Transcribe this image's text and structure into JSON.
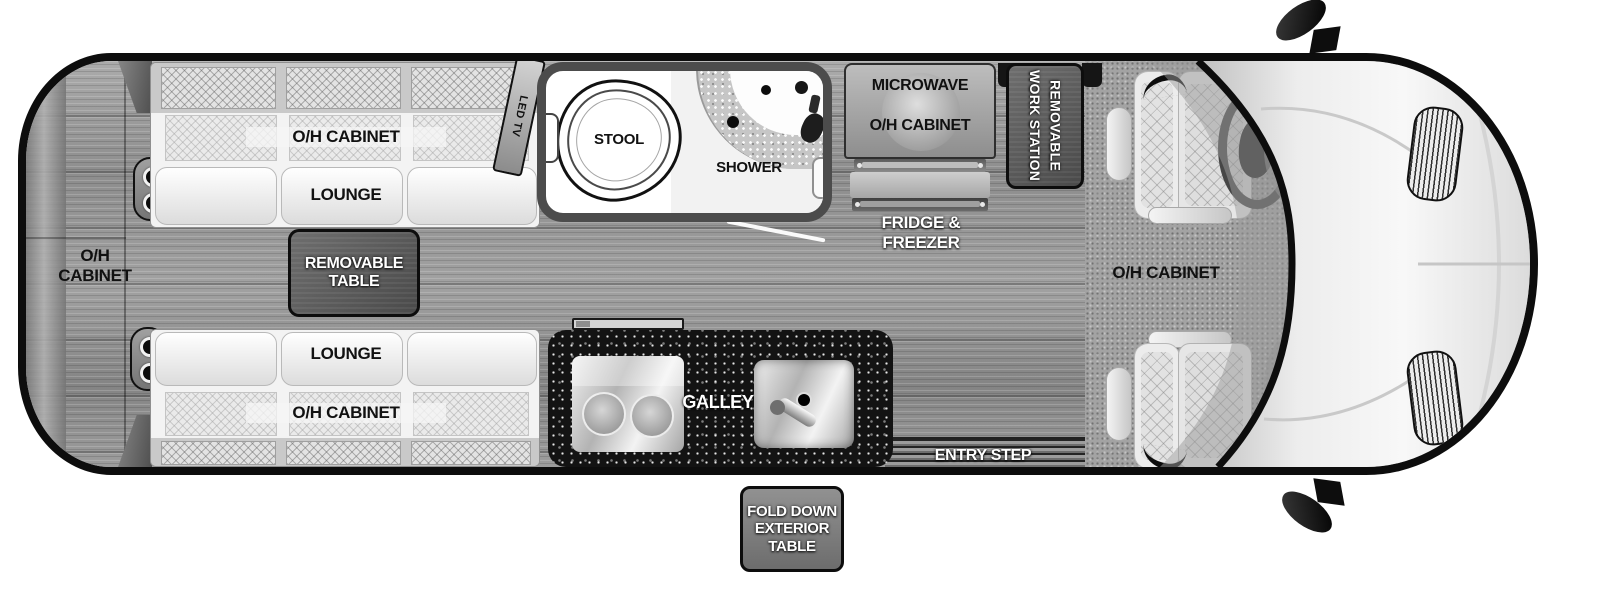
{
  "colors": {
    "body_outline": "#0d0d0d",
    "wood_floor": "#979797",
    "galley_counter": "#131313",
    "panel_dark": "#555555",
    "label_dark": "#111111",
    "label_light": "#ffffff"
  },
  "areas": {
    "rear_cabinet": {
      "label": "O/H CABINET"
    },
    "top_lounge": {
      "cabinet_label": "O/H CABINET",
      "lounge_label": "LOUNGE"
    },
    "bottom_lounge": {
      "lounge_label": "LOUNGE",
      "cabinet_label": "O/H CABINET"
    },
    "removable_table": {
      "label": "REMOVABLE TABLE"
    },
    "tv": {
      "label": "LED TV"
    },
    "bathroom": {
      "stool_label": "STOOL",
      "shower_label": "SHOWER"
    },
    "kitchen": {
      "microwave_label": "MICROWAVE",
      "microwave_cabinet_label": "O/H CABINET",
      "fridge_label": "FRIDGE & FREEZER"
    },
    "work_station": {
      "label": "REMOVABLE WORK STATION"
    },
    "cab": {
      "cabinet_label": "O/H CABINET"
    },
    "galley": {
      "label": "GALLEY"
    },
    "entry": {
      "step_label": "ENTRY STEP",
      "exterior_table_label": "FOLD DOWN EXTERIOR TABLE"
    }
  }
}
